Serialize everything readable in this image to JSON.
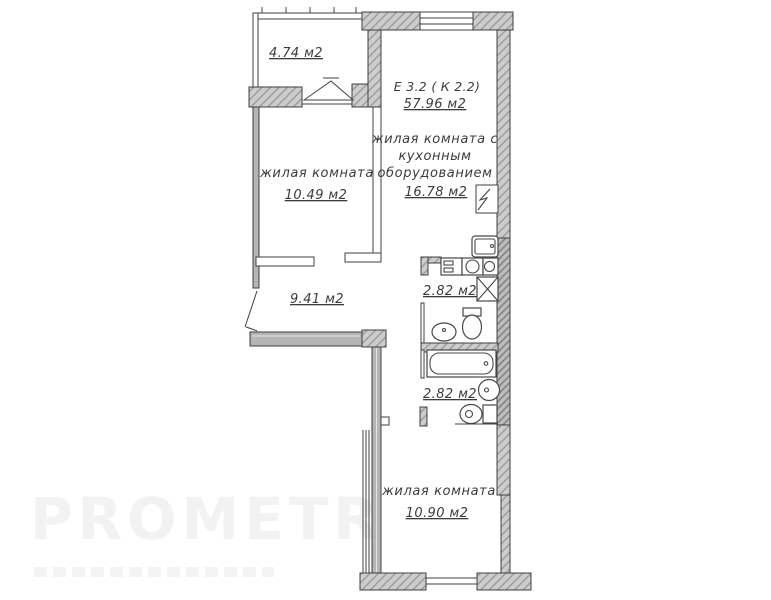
{
  "colors": {
    "wall-fill": "#cdcdcd",
    "wall-hatch": "#9a9a9a",
    "wall-dark-fill": "#bdbdbd",
    "wall-dark-hatch": "#828282",
    "wall-solid": "#b5b5b5",
    "line": "#3f3f3f",
    "text": "#3c3c3c",
    "watermark": "#f2f2f2"
  },
  "unit": {
    "label": "Е 3.2 ( К 2.2)",
    "area": "57.96 м2"
  },
  "rooms": {
    "balcony": {
      "area": "4.74 м2"
    },
    "living_room_1": {
      "name": "жилая комната",
      "area": "10.49 м2"
    },
    "kitchen_living": {
      "name_line_1": "жилая комната с",
      "name_line_2": "кухонным",
      "name_line_3": "оборудованием",
      "area": "16.78 м2"
    },
    "hallway": {
      "area": "9.41 м2"
    },
    "bathroom_1": {
      "area": "2.82 м2"
    },
    "bathroom_2": {
      "area": "2.82 м2"
    },
    "living_room_2": {
      "name": "жилая комната",
      "area": "10.90 м2"
    }
  },
  "watermark": {
    "text": "PROMETR"
  }
}
